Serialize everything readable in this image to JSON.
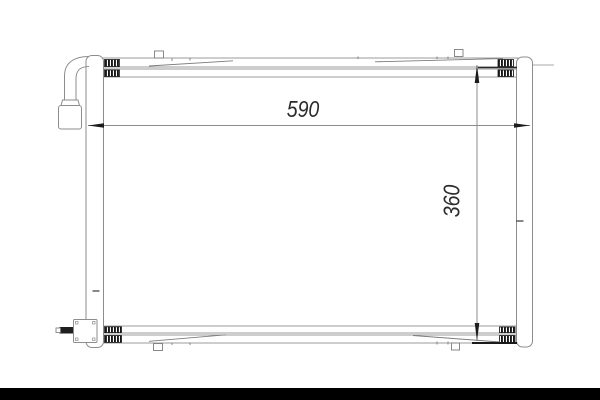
{
  "drawing": {
    "description": "Technical outline line drawing of an automotive A/C condenser (radiator) front view with two side tanks, top and bottom header tubes, an elbow inlet pipe at top-left, a fitting block with stub pipe at bottom-left, and overall dimension callouts",
    "dimensions": {
      "width_label": "590",
      "height_label": "360"
    },
    "colors": {
      "background": "#ffffff",
      "outline_gray": "#8d8d8d",
      "dark_detail": "#1c1c1c",
      "footer_bar": "#000000"
    }
  }
}
